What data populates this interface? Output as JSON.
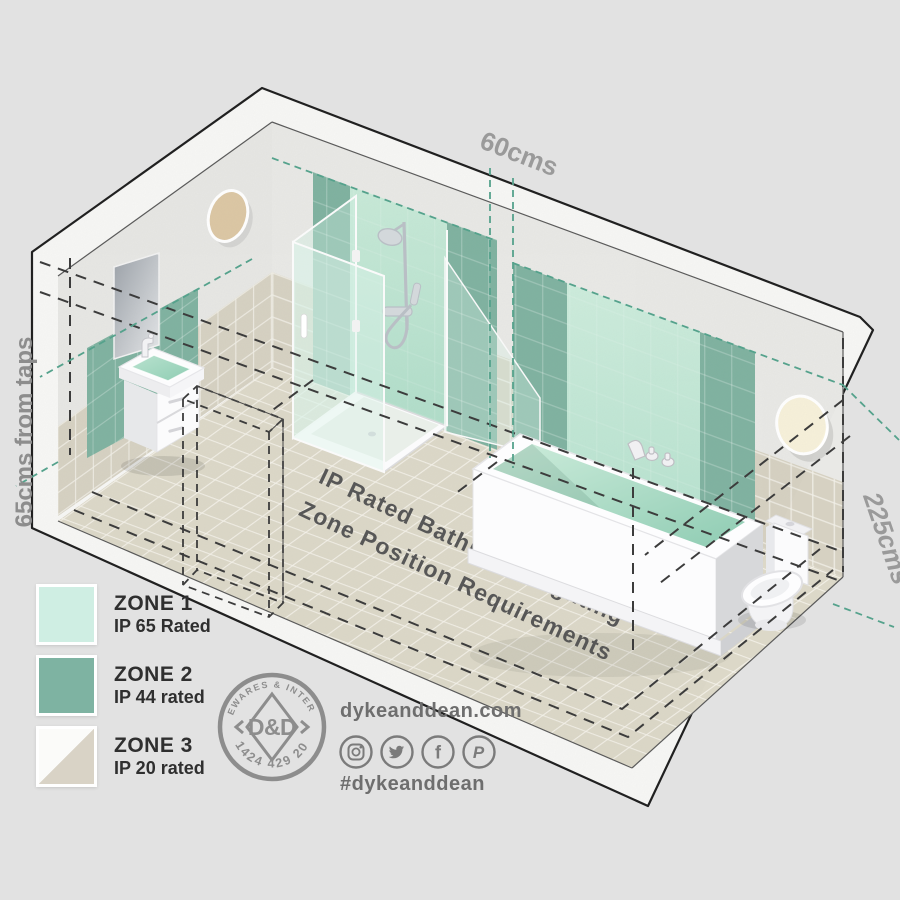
{
  "title_block": {
    "line1": "IP Rated Bathroom Lighting",
    "line2": "Zone Position Requirements"
  },
  "dimension_labels": {
    "top": "60cms",
    "left": "65cms from taps",
    "right": "225cms"
  },
  "legend": {
    "zones": [
      {
        "name": "ZONE 1",
        "rating": "IP 65 Rated",
        "swatch": "#cfeee3"
      },
      {
        "name": "ZONE 2",
        "rating": "IP 44 rated",
        "swatch": "#7eb3a2"
      },
      {
        "name": "ZONE 3",
        "rating": "IP 20 rated",
        "swatch_top": "#fbfbf9",
        "swatch_bottom": "#d9d3c6"
      }
    ]
  },
  "badge": {
    "arc_top": "HOMEWARES & INTERIORS",
    "arc_bottom": "01424 429 202",
    "monogram": "D&D"
  },
  "footer": {
    "website": "dykeanddean.com",
    "hashtag": "#dykeanddean",
    "icons": [
      "instagram",
      "twitter",
      "facebook",
      "pinterest"
    ],
    "social_glyphs": {
      "facebook": "f",
      "pinterest": "P"
    }
  },
  "palette": {
    "background": "#e2e2e2",
    "zone1_mint": "#cfeee3",
    "zone2_sage": "#7eb3a2",
    "zone3_beige": "#d9d3c6",
    "teal_dash": "#55a28c",
    "dark_dash": "#3c3c3c",
    "floor": "#dcd8c8",
    "label_gray": "#9a9a9a"
  }
}
